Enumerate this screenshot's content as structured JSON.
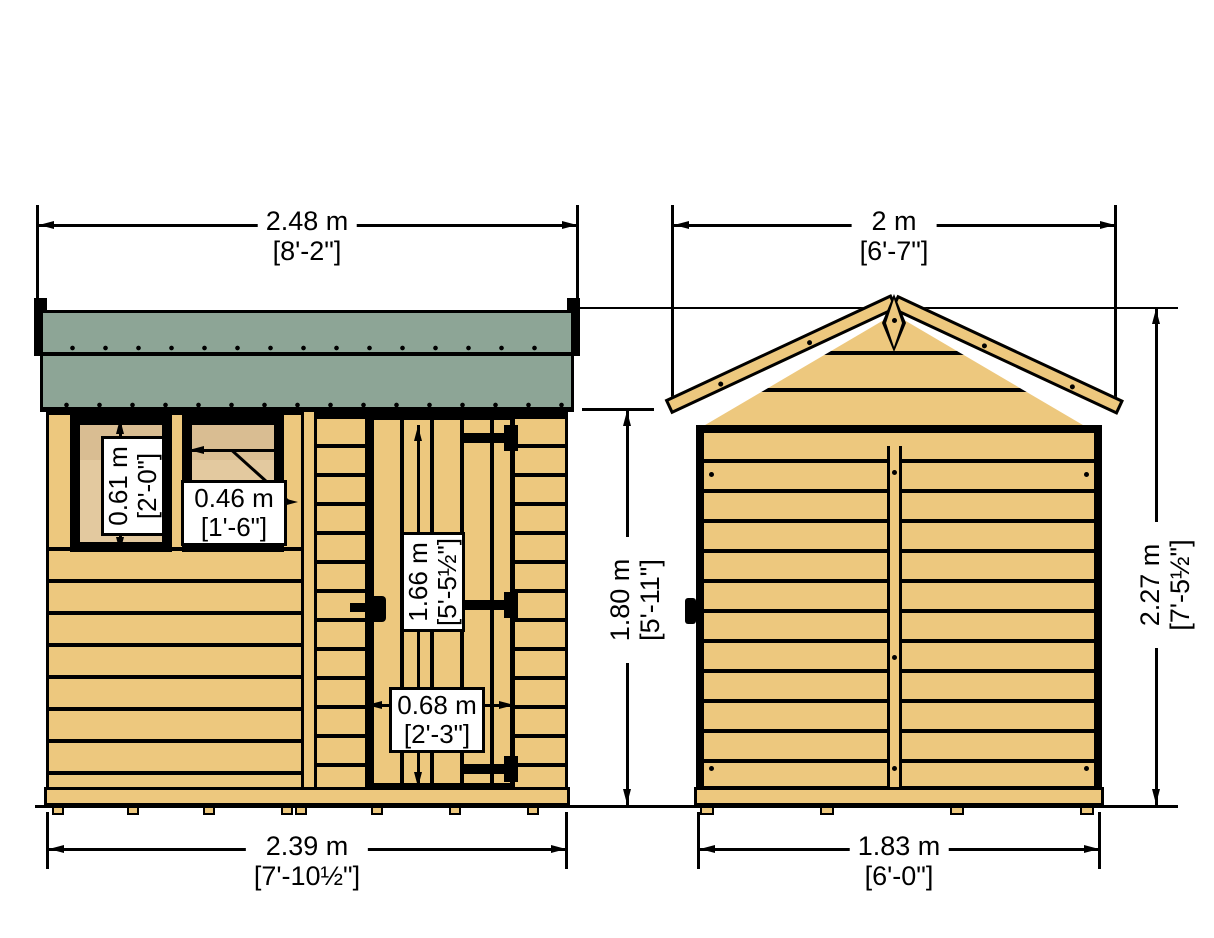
{
  "drawing": {
    "title": "shed-dimension-drawing",
    "views": {
      "left": "front-elevation",
      "right": "side-elevation"
    },
    "front": {
      "roof_width_m": "2.48 m",
      "roof_width_ft": "[8'-2\"]",
      "window1_h_m": "0.61 m",
      "window1_h_ft": "[2'-0\"]",
      "window2_h_m": "0.46 m",
      "window2_h_ft": "[1'-6\"]",
      "door_h_m": "1.66 m",
      "door_h_ft": "[5'-5½\"]",
      "door_w_m": "0.68 m",
      "door_w_ft": "[2'-3\"]",
      "eaves_h_m": "1.80 m",
      "eaves_h_ft": "[5'-11\"]",
      "base_w_m": "2.39 m",
      "base_w_ft": "[7'-10½\"]"
    },
    "side": {
      "roof_width_m": "2 m",
      "roof_width_ft": "[6'-7\"]",
      "ridge_h_m": "2.27 m",
      "ridge_h_ft": "[7'-5½\"]",
      "base_w_m": "1.83 m",
      "base_w_ft": "[6'-0\"]"
    },
    "colors": {
      "wood": "#edc87e",
      "glass": "#e3c99f",
      "felt": "#8da596",
      "outline": "#000000",
      "paper": "#ffffff"
    }
  }
}
